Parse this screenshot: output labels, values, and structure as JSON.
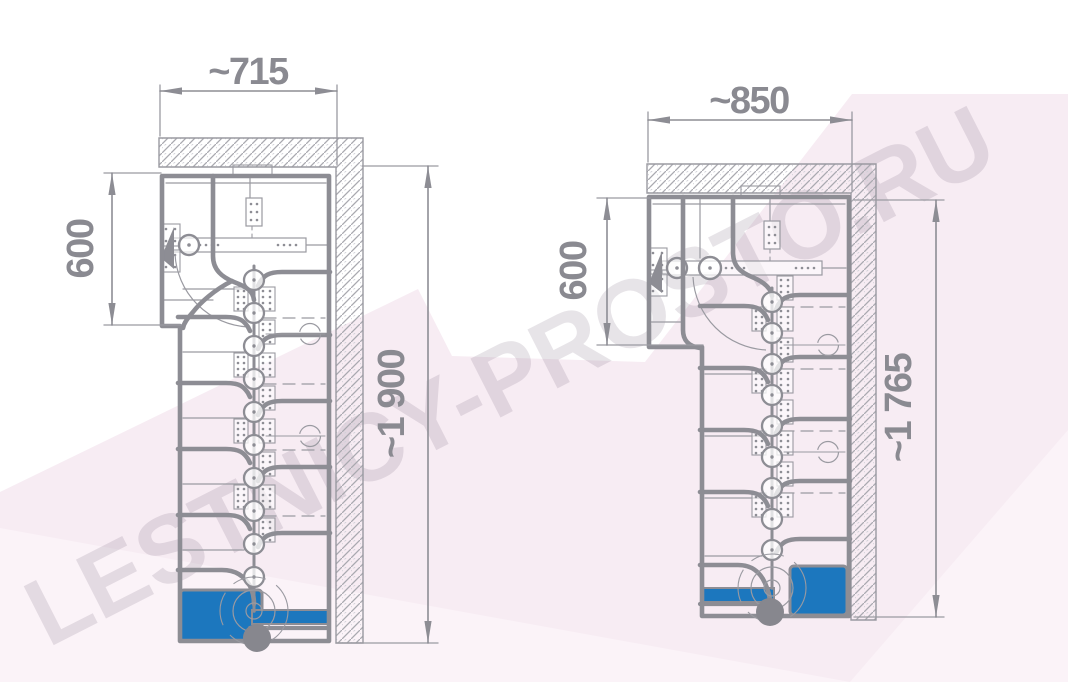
{
  "title": "Modular staircase plan drawings with dimensions",
  "watermark": {
    "text": "LESTNICY-PROSTO.RU"
  },
  "colors": {
    "line_gray": "#8d8d94",
    "thin_gray": "#9a9aa1",
    "hatch_main": "#a9a9b0",
    "hatch_light": "#cfcfd6",
    "blue": "#1c77be",
    "pole": "#87878e",
    "dim_text": "#8a8a91",
    "pink": "#f7ecf3",
    "pink_light": "#fbf3f8",
    "watermark_fill": "rgba(108,88,112,0.16)"
  },
  "drawings": [
    {
      "name": "variant-715",
      "dimensions": {
        "width": "~715",
        "landing_depth": "600",
        "length": "~1 900"
      },
      "spine_modules": 10
    },
    {
      "name": "variant-850",
      "dimensions": {
        "width": "~850",
        "landing_depth": "600",
        "length": "~1 765"
      },
      "spine_modules": 9
    }
  ]
}
